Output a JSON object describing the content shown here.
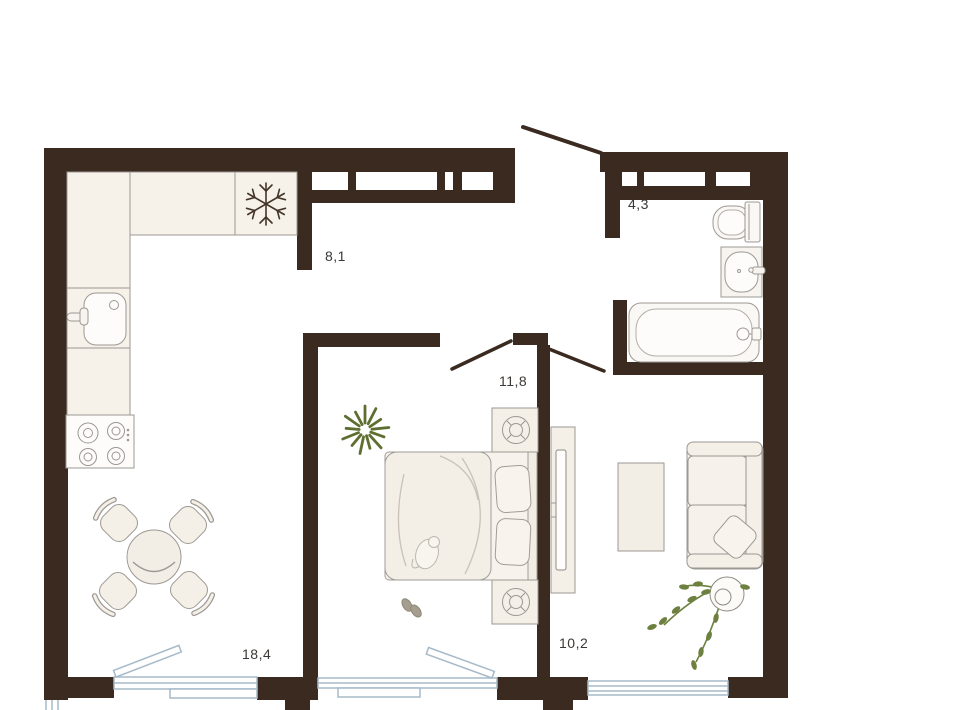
{
  "plan": {
    "name": "Two-room apartment floor plan",
    "rooms": {
      "kitchen_living": {
        "name": "kitchen-living-room",
        "area_label": "18,4"
      },
      "hallway": {
        "name": "hallway",
        "area_label": "8,1"
      },
      "bathroom": {
        "name": "bathroom",
        "area_label": "4,3"
      },
      "bedroom": {
        "name": "bedroom",
        "area_label": "11,8"
      },
      "living_room": {
        "name": "living-room",
        "area_label": "10,2"
      }
    },
    "colors": {
      "wall": "#3a2a20",
      "furniture_fill": "#f4efe7",
      "furniture_fill_light": "#faf8f4",
      "furniture_stroke": "#9c9893",
      "glazing": "#a6bac9",
      "plant_green": "#5d6e2f",
      "plant_green_light": "#6e8040",
      "slipper": "#a59d8d",
      "snowflake": "#443528",
      "label_text": "#3b3835",
      "background": "#ffffff"
    },
    "icons": {
      "fridge": "snowflake-icon",
      "stove": "stove-burners-icon",
      "kitchen_sink": "kitchen-sink-icon",
      "toilet": "toilet-icon",
      "washbasin": "washbasin-icon",
      "bathtub": "bathtub-icon",
      "dining": "dining-table-icon",
      "bed": "double-bed-icon",
      "sofa": "sofa-icon",
      "tv": "tv-unit-icon",
      "plants": "potted-plant-icon"
    }
  }
}
